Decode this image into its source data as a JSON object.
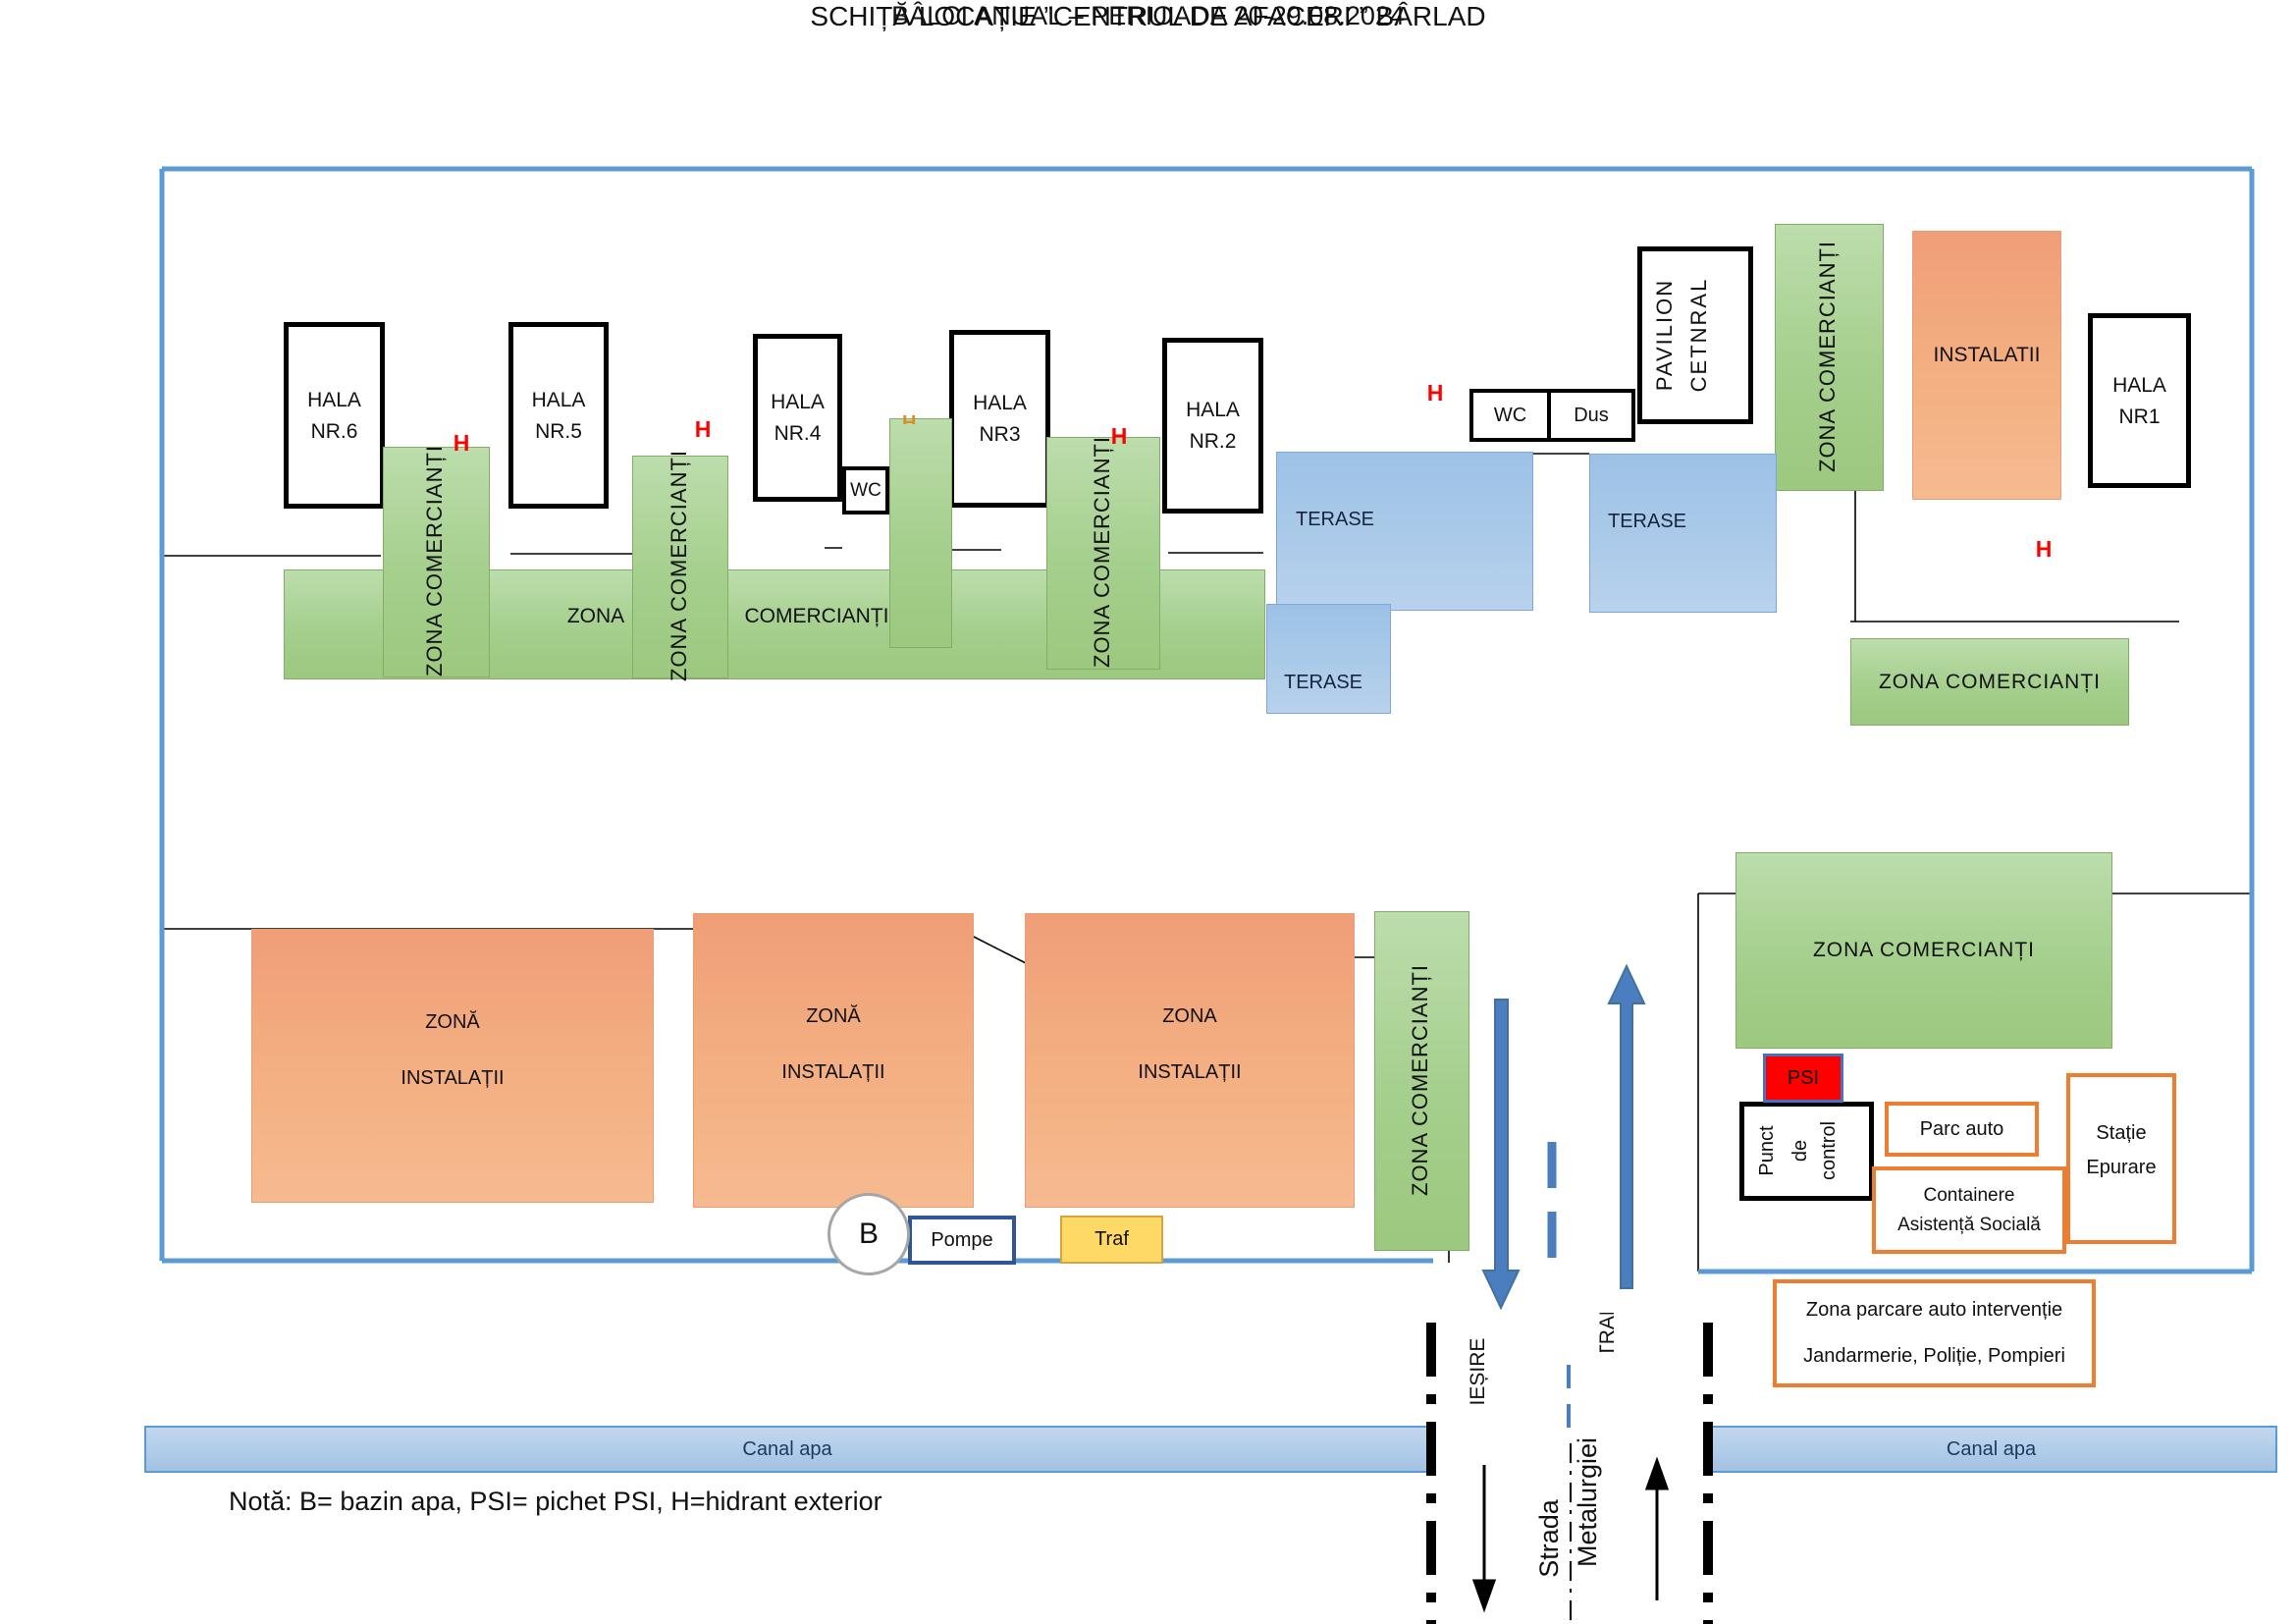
{
  "header": {
    "title": "SCHIȚĂ LOCAȚIE ”CENTRUL DE AFACERI ” BÂRLAD",
    "subtitle": "BÂLCI ANUAL – PERIOADA 20-29.08.2024"
  },
  "zones": {
    "zona_comercianti": "ZONA COMERCIANȚI",
    "zona": "ZONA",
    "comercianti": "COMERCIANȚI",
    "terase": "TERASE",
    "instalatii_caps": "INSTALATII"
  },
  "halls": {
    "h6": {
      "l1": "HALA",
      "l2": "NR.6"
    },
    "h5": {
      "l1": "HALA",
      "l2": "NR.5"
    },
    "h4": {
      "l1": "HALA",
      "l2": "NR.4"
    },
    "h3": {
      "l1": "HALA",
      "l2": "NR3"
    },
    "h2": {
      "l1": "HALA",
      "l2": "NR.2"
    },
    "h1": {
      "l1": "HALA",
      "l2": "NR1"
    }
  },
  "instal_zones": {
    "z1": {
      "l1": "ZONĂ",
      "l2": "INSTALAȚII"
    },
    "z2": {
      "l1": "ZONĂ",
      "l2": "INSTALAȚII"
    },
    "z3": {
      "l1": "ZONA",
      "l2": "INSTALAȚII"
    }
  },
  "facilities": {
    "wc": "WC",
    "dus": "Dus",
    "pavilion_l1": "PAVILION",
    "pavilion_l2": "CETNRAL",
    "pompe": "Pompe",
    "traf": "Traf",
    "psi": "PSI",
    "punct_l1": "Punct",
    "punct_l2": "de",
    "punct_l3": "control",
    "parc_auto": "Parc auto",
    "containere_l1": "Containere",
    "containere_l2": "Asistență Socială",
    "statie_l1": "Stație",
    "statie_l2": "Epurare"
  },
  "parking_box": {
    "l1": "Zona parcare auto intervenție",
    "l2": "Jandarmerie, Poliție, Pompieri"
  },
  "markers": {
    "hydrant": "H",
    "bazin": "B"
  },
  "road": {
    "strada": "Strada",
    "metalurgiei": "Metalurgiei",
    "iesire": "IEȘIRE",
    "intrare": "INTRARE"
  },
  "canal": {
    "label": "Canal apa"
  },
  "note": "Notă: B= bazin apa,  PSI= pichet PSI,  H=hidrant exterior",
  "colors": {
    "site_border_blue": "#5B9BD5",
    "zone_green": "#A9D18E",
    "zone_orange": "#F4B183",
    "terase_blue": "#9DC3E6",
    "canal_blue": "#AECBE8",
    "accent_orange_border": "#ED7D31",
    "psi_red": "#FF0000",
    "arrow_blue": "#4A7EBF",
    "traf_yellow": "#FFD966"
  }
}
